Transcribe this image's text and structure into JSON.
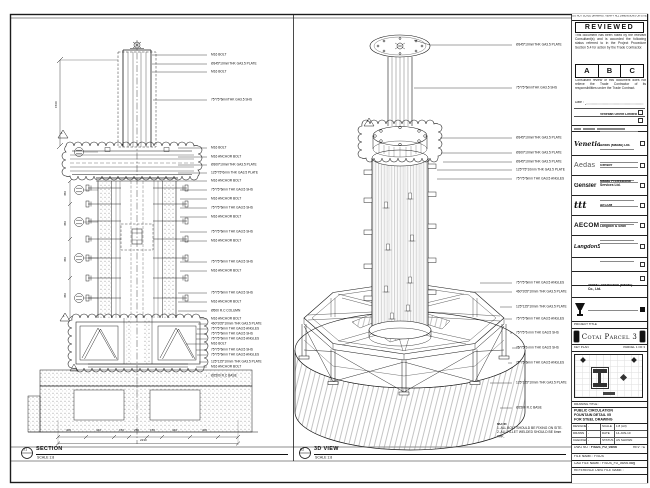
{
  "views": {
    "section": {
      "bubble_no": "01",
      "title": "SECTION",
      "scale": "SCALE 1:8"
    },
    "iso": {
      "bubble_no": "02",
      "title": "3D VIEW",
      "scale": "SCALE 1:8"
    },
    "note_heading": "NOTE:",
    "notes": [
      "1. ALL BOLT SHOULD BE FIXING ON SITE.",
      "2. ALL FILLET WELDED SHOULD BE 6mm THK."
    ],
    "revision_marker": "1"
  },
  "left_view": {
    "callouts": [
      "M16 BOLT",
      "Ø345*10mmTHK GA3.5 PLATE",
      "M16 BOLT",
      "75*75*6mmTHK GA3.5 SHS",
      "M16 BOLT",
      "M16 ANCHOR BOLT",
      "Ø300*10mmTHK GA3.5 PLATE",
      "125*75*6mm THK GA3.5 PLATE",
      "M16 ANCHOR BOLT",
      "75*75*6mm THK GA3.5 SHS",
      "M16 ANCHOR BOLT",
      "75*75*6mm THK GA3.5 SHS",
      "M16 ANCHOR BOLT",
      "75*75*6mm THK GA3.5 SHS",
      "M16 ANCHOR BOLT",
      "75*75*6mm THK GA3.5 SHS",
      "M16 ANCHOR BOLT",
      "75*75*6mm THK GA3.5 SHS",
      "M16 ANCHOR BOLT",
      "Ø500 R.C COLUMN",
      "M16 ANCHOR BOLT",
      "460*205*10mm THK GA3.5 PLATE",
      "75*75*6mm THK GA3.5 ANGLES",
      "75*75*6mm THK GA3.5 SHS",
      "75*75*6mm THK GA3.5 ANGLES",
      "M16 BOLT",
      "75*75*6mm THK GA3.5 SHS",
      "75*75*6mm THK GA3.5 ANGLES",
      "125*125*10mm THK GA3.5 PLATE",
      "M16 ANCHOR BOLT",
      "Ø2500 R.C BASE"
    ],
    "dims_bottom": [
      "400",
      "440",
      "150",
      "250",
      "150",
      "440",
      "400"
    ],
    "dim_total": "2230",
    "dims_left": [
      "450",
      "450",
      "450",
      "450"
    ],
    "dim_top": "1560"
  },
  "right_view": {
    "callouts": [
      "Ø345*10mmTHK GA3.5 PLATE",
      "75*75*6mmTHK GA3.5 SHS",
      "Ø345*10mmTHK GA3.5 PLATE",
      "Ø300*10mmTHK GA3.5 PLATE",
      "Ø345*10mmTHK GA3.5 PLATE",
      "125*75*10mm THK GA3.5 PLATE",
      "75*75*6mm THK GA3.5 ANGLES",
      "75*75*6mm THK GA3.5 ANGLES",
      "460*205*10mm THK GA3.5 PLATE",
      "125*125*10mm THK GA3.5 PLATE",
      "75*75*6mm THK GA3.5 ANGLES",
      "75*75*6 mm THK GA3.5 SHS",
      "75*75*6 mm THK GA3.5 SHS",
      "75*75*6mm THK GA3.5 ANGLES",
      "125*125*10mm THK GA3.5 PLATE",
      "Ø2500 R.C BASE"
    ]
  },
  "title_block": {
    "warning": "DO NOT SCALE DRAWING. VERIFY ALL DIMENSIONS ON SITE",
    "reviewed": {
      "title": "REVIEWED",
      "body1": "This document has been noted by the relevant Consultant(s) and is accorded the following status referred to in the Project Procedure Section 5.4 for action by the Trade Contractor.",
      "grades": [
        "A",
        "B",
        "C"
      ],
      "body2": "Consultant review of this document does not relieve the Trade Contractor of its responsibilities under the Trade Contract.",
      "date_label": "Date :"
    },
    "consultants": [
      {
        "logo_text": "Venetian",
        "name": "Venetian Orient Limited"
      },
      {
        "logo_text": "Aedas",
        "name": "Aedas (Macau) Ltd."
      },
      {
        "logo_text": "Gensler",
        "name": "Gensler"
      },
      {
        "logo_text": "ttt",
        "name": "Macau Professional Services Ltd."
      },
      {
        "logo_text": "AECOM",
        "name": "AECOM"
      },
      {
        "logo_text": "LangdonSeah",
        "name": "Langdon & Seah"
      }
    ],
    "contractor": {
      "name": "Yadea Construction (Macau) Co., Ltd."
    },
    "project_title_label": "PROJECT TITLE",
    "project_title": "Cotai Parcel 3",
    "key_plan_label": "KEY PLAN",
    "key_plan_right": "PARCEL 1 OF 3",
    "drawing_title_label": "DRAWING TITLE :",
    "drawing_title_lines": [
      "PUBLIC CIRCULATION",
      "FOUNTAIN DETAIL 05",
      "FOR STEEL DRAWING"
    ],
    "fields": {
      "designed_label": "DESIGNED",
      "designed": "-",
      "drawn_label": "DRAWN",
      "drawn": "-",
      "checked_label": "CHECKED",
      "checked": "-",
      "scale_label": "SCALE",
      "scale": "1:8 (A3)",
      "date_label": "DATE",
      "date": "14-JUN-10",
      "status_label": "STATUS",
      "status": "AS SHOWN"
    },
    "dwg_no_label": "DWG NO :",
    "dwg_no": "F/SUS_FD_05/06",
    "rev_label": "REV :",
    "rev": "C",
    "file_label": "FILE NAME :",
    "file": "F/SUS",
    "cad_label": "CAD FILE NAME :",
    "cad": "F/SUS_FD_05/06.dwg",
    "ref_label": "REFERENCE DWG FILE NAME :"
  }
}
